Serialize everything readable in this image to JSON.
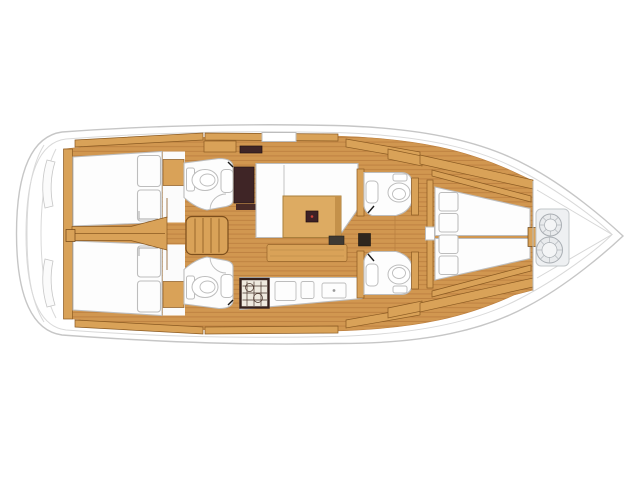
{
  "diagram": {
    "kind": "sailboat-interior-floor-plan",
    "orientation": "bow-right",
    "components": [
      "hull",
      "swim-platform",
      "aft-cabin-upper",
      "aft-cabin-lower",
      "aft-head-upper",
      "aft-head-lower",
      "companionway-steps",
      "nav-station",
      "salon-settee",
      "salon-table",
      "salon-bench",
      "galley-counter",
      "stove",
      "fwd-head-upper",
      "fwd-head-lower",
      "v-berth-cabin",
      "anchor-locker"
    ],
    "counts": {
      "berth-pillows-aft": 4,
      "berth-pillows-fwd": 4,
      "toilets": 4,
      "rope-coils": 2
    }
  },
  "colors": {
    "hull_line": "#c6c6c6",
    "deck_line": "#d9d9d9",
    "floor_base": "#d19750",
    "plank_line": "#bd8040",
    "wood_trim": "#d9a258",
    "wood_edge": "#8a5a22",
    "furniture_white": "#fdfdfd",
    "furniture_line": "#bdbdbd",
    "dark_brown": "#3f2526",
    "table_wood": "#ddab62",
    "stove_frame": "#35201c",
    "metal_gray": "#a9aeb3",
    "accent_red": "#d04038"
  }
}
